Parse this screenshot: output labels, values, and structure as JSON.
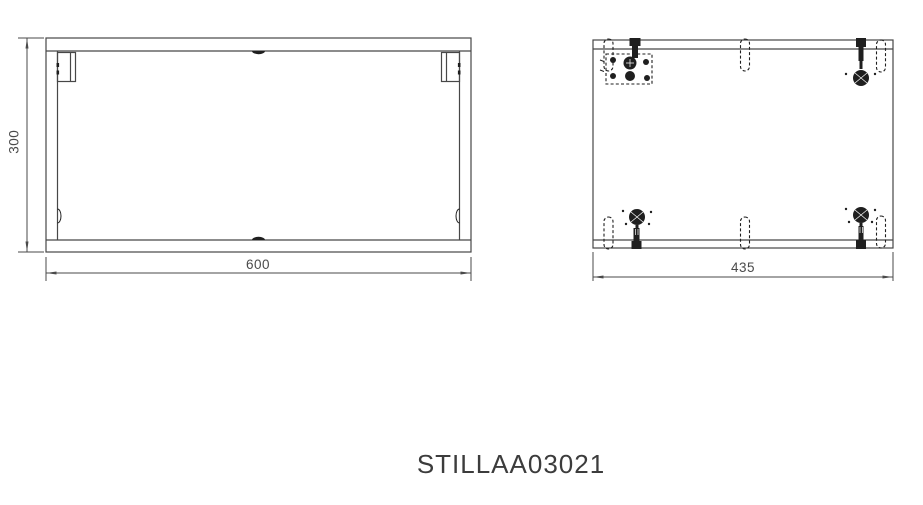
{
  "drawing": {
    "part_number": "STILLAA03021",
    "views": {
      "front": {
        "width_dim": "600",
        "height_dim": "300"
      },
      "side": {
        "depth_dim": "435"
      }
    },
    "colors": {
      "line": "#474747",
      "hardware": "#1f1f1f",
      "dimension": "#4a4a4a",
      "text": "#3c3c3c",
      "background": "#ffffff"
    }
  }
}
